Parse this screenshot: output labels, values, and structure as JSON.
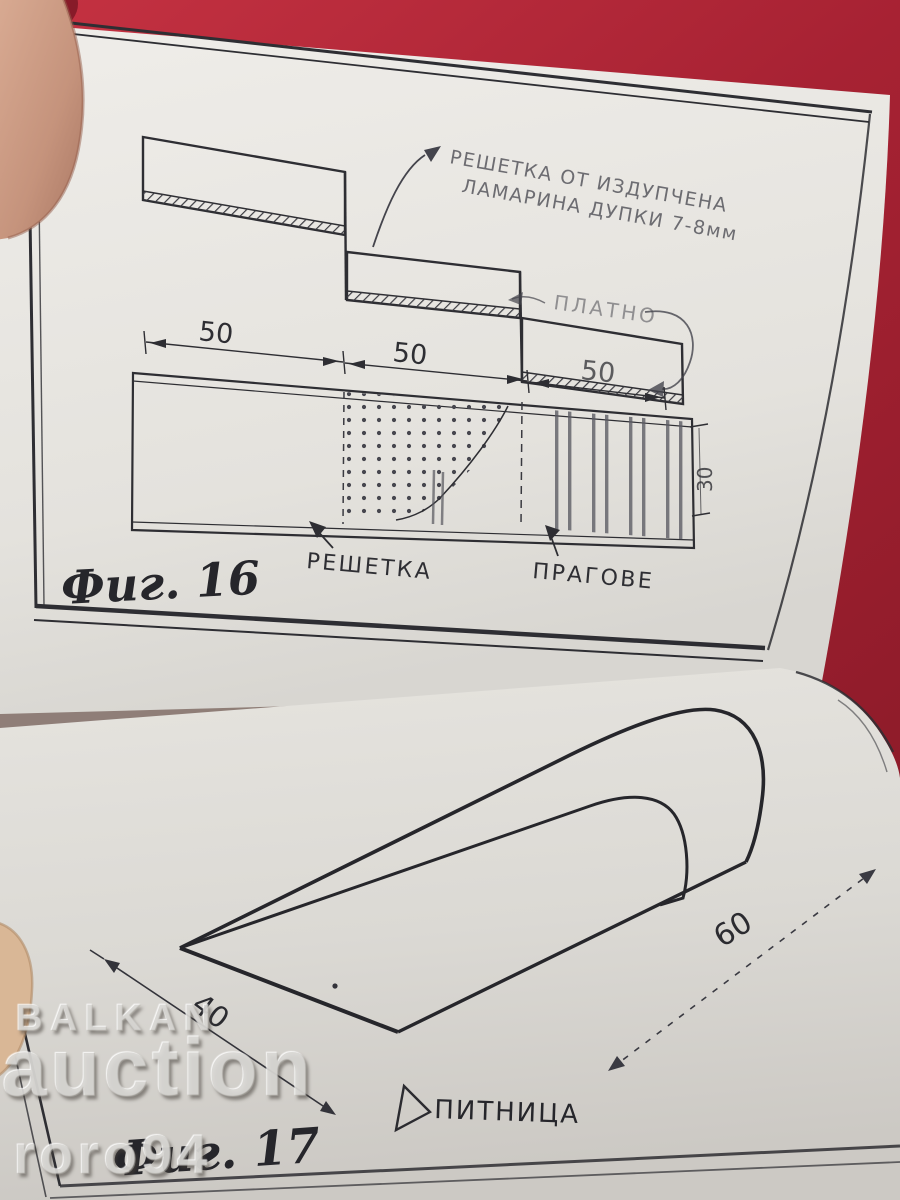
{
  "colors": {
    "cloth_red": "#b12737",
    "page_light": "#eae8e3",
    "ink": "#2e2e33"
  },
  "figure16": {
    "caption": "Фиг. 16",
    "note_line1": "РЕШЕТКА ОТ ИЗДУПЧЕНА",
    "note_line2": "ЛАМАРИНА  ДУПКИ 7-8мм",
    "label_platno": "ПЛАТНО",
    "label_reshetka": "РЕШЕТКА",
    "label_pragove": "ПРАГОВЕ",
    "dims": [
      "50",
      "50",
      "50"
    ],
    "dim_height": "30"
  },
  "figure17": {
    "caption": "Фиг. 17",
    "label_pitnitsa": "ПИТНИЦА",
    "dim_width": "40",
    "dim_length": "60"
  },
  "watermark": {
    "line1": "BALKAN",
    "line2": "auction",
    "line3": "roro94"
  }
}
